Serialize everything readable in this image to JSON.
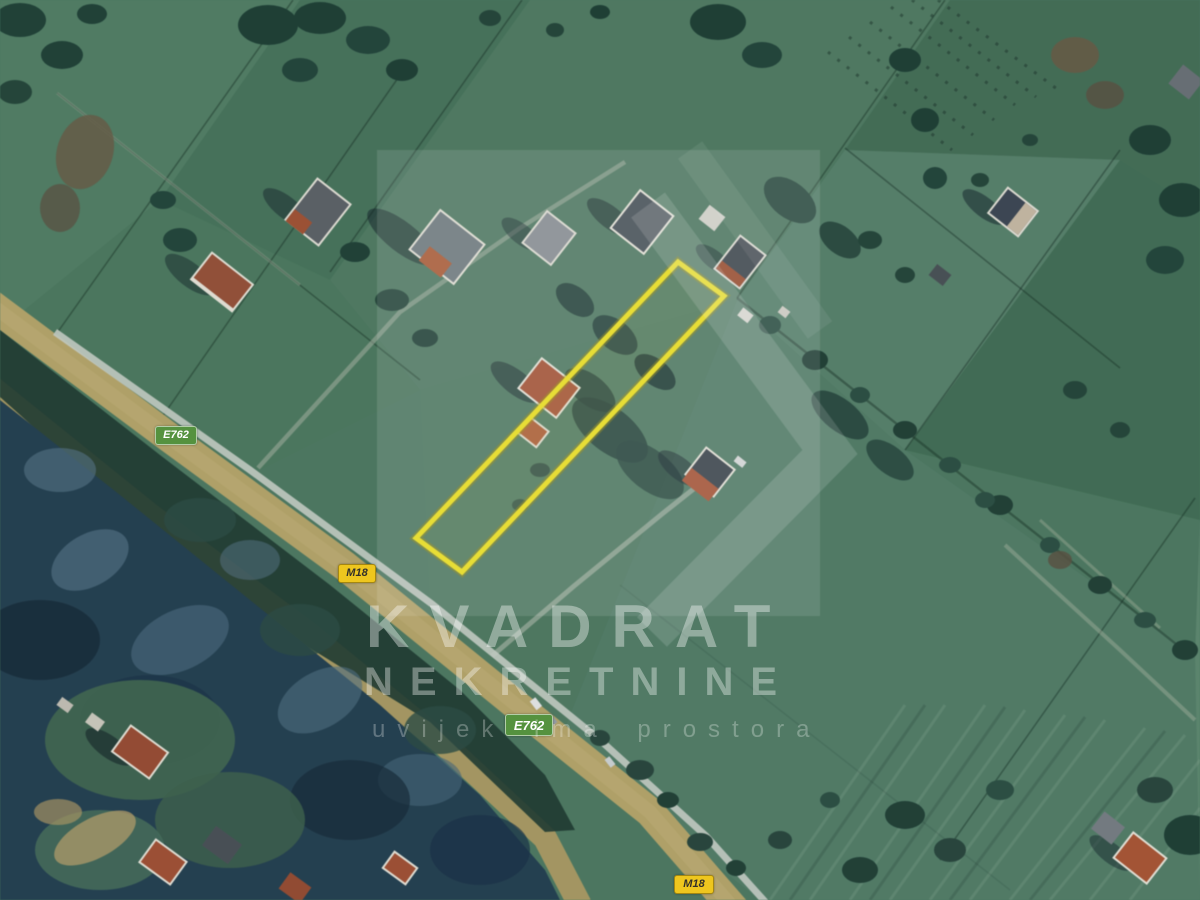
{
  "image": {
    "description": "Aerial satellite photo of rural land parcels along a highway with a highlighted plot outlined in yellow",
    "width_px": 1200,
    "height_px": 900
  },
  "road_badges": [
    {
      "label": "E762",
      "type": "european-route",
      "bg_color": "#55923f",
      "text_color": "#ffffff",
      "position": "upper-left"
    },
    {
      "label": "M18",
      "type": "main-road",
      "bg_color": "#eec61e",
      "text_color": "#32302a",
      "position": "mid-left"
    },
    {
      "label": "E762",
      "type": "european-route",
      "bg_color": "#55923f",
      "text_color": "#ffffff",
      "position": "lower-center"
    },
    {
      "label": "M18",
      "type": "main-road",
      "bg_color": "#eec61e",
      "text_color": "#32302a",
      "position": "bottom-center"
    }
  ],
  "watermark": {
    "title": "KVADRAT",
    "subtitle": "NEKRETNINE",
    "tagline": "uvijek ima prostora",
    "color": "#ffffff"
  },
  "parcel": {
    "highlight_color": "#f4e40a",
    "shape": "long narrow rotated rectangle"
  },
  "palette": {
    "field_green": "#4b7a60",
    "road_tan": "#b9a565",
    "forest_dark": "#223f52",
    "gravel_road": "#c9cfc6",
    "roof_red": "#ad4f2e"
  }
}
